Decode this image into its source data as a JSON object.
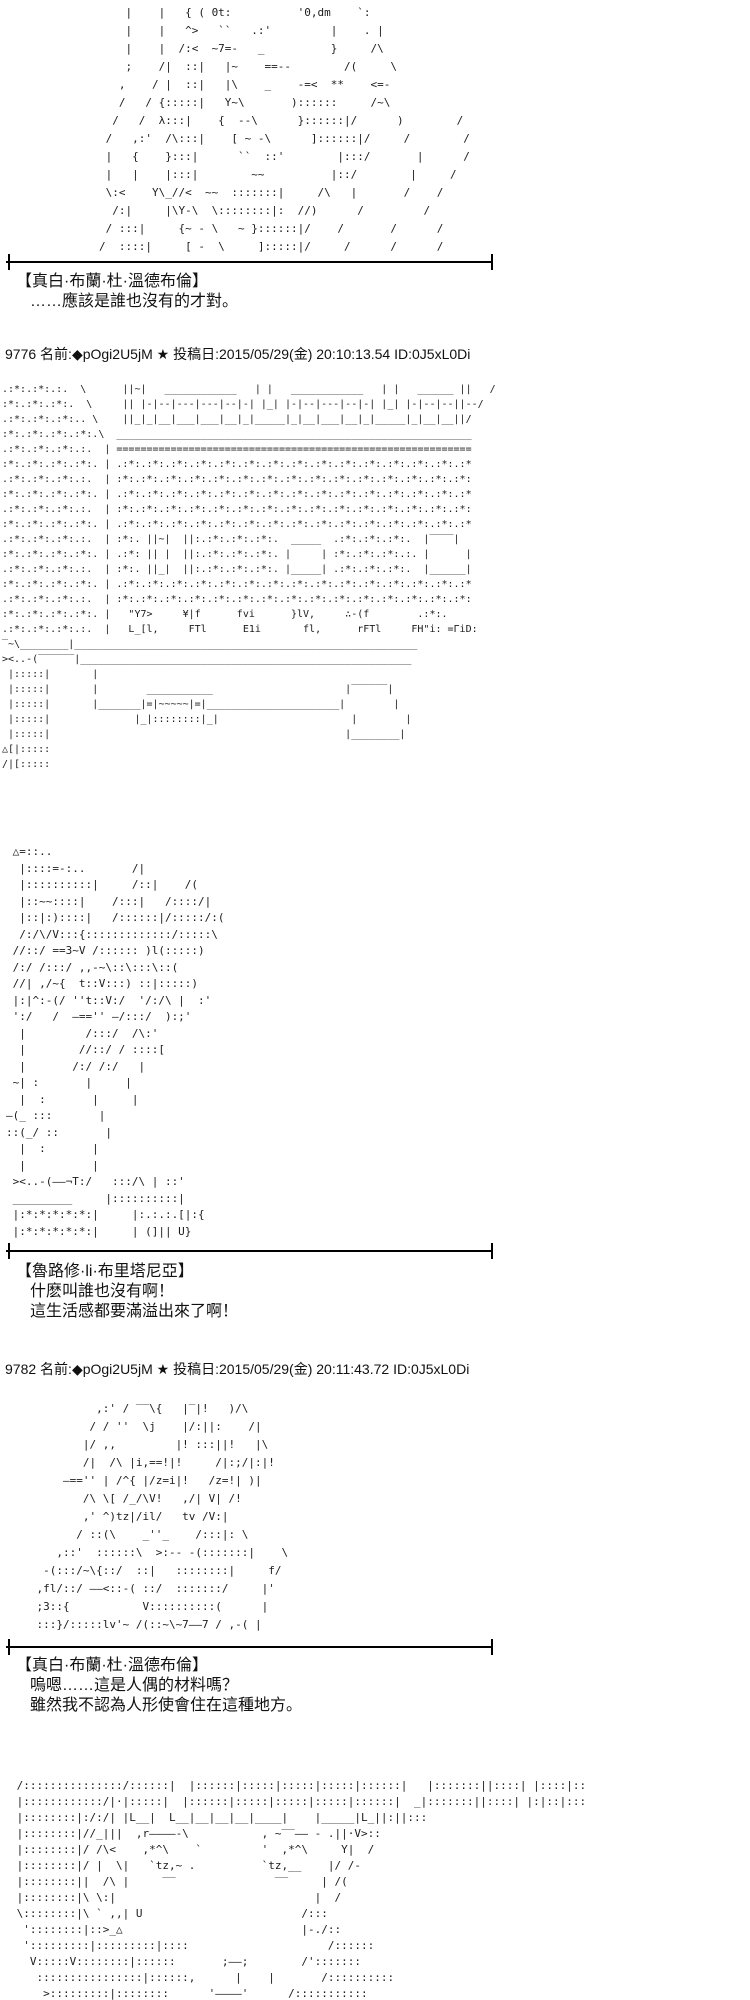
{
  "page": {
    "background": "#ffffff",
    "text_color": "#111111",
    "divider_color": "#000000"
  },
  "posts": [
    {
      "number": "9776",
      "name_label": "名前:",
      "tripcode": "◆pOgi2U5jM",
      "star": "★",
      "date_label": "投稿日:",
      "datetime": "2015/05/29(金) 20:10:13.54",
      "id": "ID:0J5xL0Di"
    },
    {
      "number": "9782",
      "name_label": "名前:",
      "tripcode": "◆pOgi2U5jM",
      "star": "★",
      "date_label": "投稿日:",
      "datetime": "2015/05/29(金) 20:11:43.72",
      "id": "ID:0J5xL0Di"
    }
  ],
  "dialogues": [
    {
      "speaker": "【真白·布蘭·杜·溫德布倫】",
      "lines": [
        "……應該是誰也沒有的才對。"
      ]
    },
    {
      "speaker": "【魯路修·li·布里塔尼亞】",
      "lines": [
        "什麽叫誰也沒有啊！",
        "這生活感都要滿溢出來了啊！"
      ]
    },
    {
      "speaker": "【真白·布蘭·杜·溫德布倫】",
      "lines": [
        "嗚嗯……這是人偶的材料嗎？",
        "雖然我不認為人形使會住在這種地方。"
      ]
    }
  ],
  "aa": {
    "top_character_partial": [
      "            |    |   { ( 0t:          '0,dm    `:",
      "            |    |   ^>   ``   .:'         |    . |",
      "            |    |  /:<  ~7=-   _          }     /\\",
      "            ;    /|  ::|   |~    ==--        /(     \\",
      "           ,    / |  ::|   |\\    _    -=<  **    <=-",
      "           /   / {:::::|   Y~\\       )::::::     /~\\",
      "          /   /  λ:::|    {  --\\      }::::::|/      )        /",
      "         /   ,:'  /\\:::|    [ ~ -\\      ]::::::|/     /        /",
      "         |   {    }:::|      ``  ::'        |:::/       |      /",
      "         |   |    |:::|        ~~          |::/        |     /",
      "         \\:<    Y\\_//<  ~~  :::::::|     /\\   |       /    /",
      "          /:|     |\\Y-\\  \\::::::::|:  //)      /         /",
      "         / :::|     {~ - \\   ~ }::::::|/    /       /      /",
      "        /  ::::|     [ -  \\     ]:::::|/     /      /      /"
    ],
    "warehouse_room": [
      ".:*:.:*:.:.  \\      ||~|   ____________   | |   ____________   | |   ______ ||   /",
      ":*:.:*:.:*:.  \\     || |-|--|---|---|--|-| |_| |-|--|---|--|-| |_| |-|--|--||--/",
      ".:*:.:*:.:*:.. \\    ||_|_|__|___|___|__|_|_____|_|__|___|__|_|_____|_|__|__||/",
      ":*:.:*:.:*:.:*:.\\  ___________________________________________________________",
      ".:*:.:*:.:*:.:.  | ===========================================================",
      ":*:.:*:.:*:.:*:. | .:*:.:*:.:*:.:*:.:*:.:*:.:*:.:*:.:*:.:*:.:*:.:*:.:*:.:*:.:*",
      ".:*:.:*:.:*:.:.  | :*:.:*:.:*:.:*:.:*:.:*:.:*:.:*:.:*:.:*:.:*:.:*:.:*:.:*:.:*:",
      ":*:.:*:.:*:.:*:. | .:*:.:*:.:*:.:*:.:*:.:*:.:*:.:*:.:*:.:*:.:*:.:*:.:*:.:*:.:*",
      ".:*:.:*:.:*:.:.  | :*:.:*:.:*:.:*:.:*:.:*:.:*:.:*:.:*:.:*:.:*:.:*:.:*:.:*:.:*:",
      ":*:.:*:.:*:.:*:. | .:*:.:*:.:*:.:*:.:*:.:*:.:*:.:*:.:*:.:*:.:*:.:*:.:*:.:*:.:*",
      ".:*:.:*:.:*:.:.  | :*:. ||~|  ||:.:*:.:*:.:*:.  _____  .:*:.:*:.:*:.  |‾‾‾‾|",
      ":*:.:*:.:*:.:*:. | .:*: || |  ||:.:*:.:*:.:*:. |     | :*:.:*:.:*:.:. |      |",
      ".:*:.:*:.:*:.:.  | :*:. ||_|  ||:.:*:.:*:.:*:. |_____| .:*:.:*:.:*:.  |______|",
      ":*:.:*:.:*:.:*:. | .:*:.:*:.:*:.:*:.:*:.:*:.:*:.:*:.:*:.:*:.:*:.:*:.:*:.:*:.:*",
      ".:*:.:*:.:*:.:.  | :*:.:*:.:*:.:*:.:*:.:*:.:*:.:*:.:*:.:*:.:*:.:*:.:*:.:*:.:*:",
      ":*:.:*:.:*:.:*:. |   \"Y7>     ¥|f      fvi      }lV,     ∴-(f        .:*:.",
      ".:*:.:*:.:*:.:.  |   L_[l,     FTl      E1i       fl,      rFTl     FH\"i: =ΓiD:",
      "‾~\\________|_________________________________________________________",
      "><..-(‾‾‾‾‾‾|_______________________________________________________",
      " |:::::|       |",
      " |:::::|       |        ___________                      |‾‾‾‾‾‾|",
      " |:::::|       |_______|=|~~~~~|=|______________________|        |",
      " |:::::|              |_|::::::::|_|                      |        |",
      " |:::::|                                                 |________|",
      "△[|:::::",
      "/|[:::::"
    ],
    "character_closeup": [
      " △=::..",
      "  |::::=-:..       /|",
      "  |::::::::::|     /::|    /(",
      "  |::~~::::|    /:::|   /::::/|",
      "  |::|:)::::|   /::::::|/:::::/:(",
      "  /:/\\/V:::{:::::::::::::/:::::\\",
      " //::/ ==3~V /:::::: )l(:::::)",
      " /:/ /:::/ ,,-~\\::\\:::\\::(",
      " //| ,/~{  t::V:::) ::|:::::)",
      " |:|^:-(/ ''t::V:/  '/:/\\ |  :'",
      " ':/   /  —=='' —/:::/  ):;'",
      "  |         /:::/  /\\:'",
      "  |        //::/ / ::::[",
      "  |       /:/ /:/   |",
      " ~| :       |     |",
      "  |  :       |     |",
      "—(_ :::       |",
      "::(_/ ::       |",
      "  |  :       |",
      "  |          |",
      " ><..-(——¬T:/   :::/\\ | ::'",
      " _________     |::::::::::|",
      " |:*:*:*:*:*:|     |:.:.:.[|:{",
      " |:*:*:*:*:*:|     | (]|| U}"
    ],
    "character_reclining": [
      "             ,:' / ‾‾\\{   |‾|!   )/\\",
      "            / / ''  \\j    |/:||:    /|",
      "           |/ ,,         |! :::||!   |\\",
      "           /|  /\\ |i,==!|!     /|:;/|:|!",
      "        —=='' | /^{ |/z=i|!   /z=!| )|",
      "           /\\ \\[ /_/\\V!   ,/| V| /!",
      "           ,' ^)tz|/il/   tv /V:|",
      "          / ::(\\    _''_    /:::|: \\",
      "       ,::'  ::::::\\  >:-- -(:::::::|    \\",
      "     -(:::/~\\{::/  ::|   ::::::::|     f/",
      "    ,fl/::/ ——<::-( ::/  :::::::/     |'",
      "    ;3::{           V::::::::::(      |",
      "    :::}/:::::lv'~ /(::~\\~7——7 / ,-( |"
    ],
    "shelf_room": [
      " /:::::::::::::::/::::::|  |::::::|:::::|:::::|:::::|::::::|   |:::::::||::::| |::::|::",
      " |::::::::::::/|·|:::::|  |::::::|:::::|:::::|:::::|::::::|  _|:::::::||::::| |:|::|:::",
      " |::::::::|:/:/| |L__|  L__|__|__|__|____|    |_____|L_||:||:::",
      " |::::::::|//_|||  ,r————-\\           , ~‾‾—— - .||·V>::",
      " |::::::::|/ /\\<    ,*^\\    `         '  ,*^\\     Y|  /",
      " |::::::::|/ |  \\|   `tz,~ .          `tz,__    |/ /-",
      " |::::::::||  /\\ |     ‾‾               ‾‾     | /( ",
      " |::::::::|\\ \\:|                              |  /",
      " \\::::::::|\\ ` ,,| U                        /:::",
      "  '::::::::|::>_△                           |-./::",
      "  ':::::::::|:::::::::|::::                     /::::::",
      "   V:::::V::::::::|::::::       ;——;        /':::::::",
      "    ::::::::::::::::|::::::,      |    |       /::::::::::",
      "     >:::::::::|::::::::      '————'      /:::::::::::"
    ]
  }
}
